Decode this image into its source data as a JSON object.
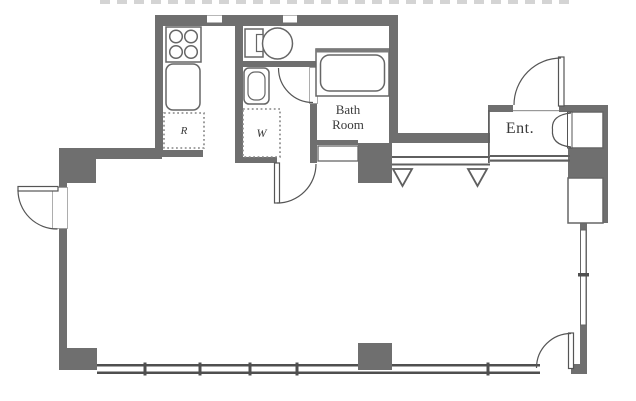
{
  "labels": {
    "refrigerator": "R",
    "washer": "W",
    "bath_line1": "Bath",
    "bath_line2": "Room",
    "entrance": "Ent."
  },
  "colors": {
    "wall": "#6f6f6f",
    "thin_line": "#555555",
    "fixture_outline": "#666666",
    "floor": "#ffffff",
    "clipped_text": "#cdcdcd"
  }
}
